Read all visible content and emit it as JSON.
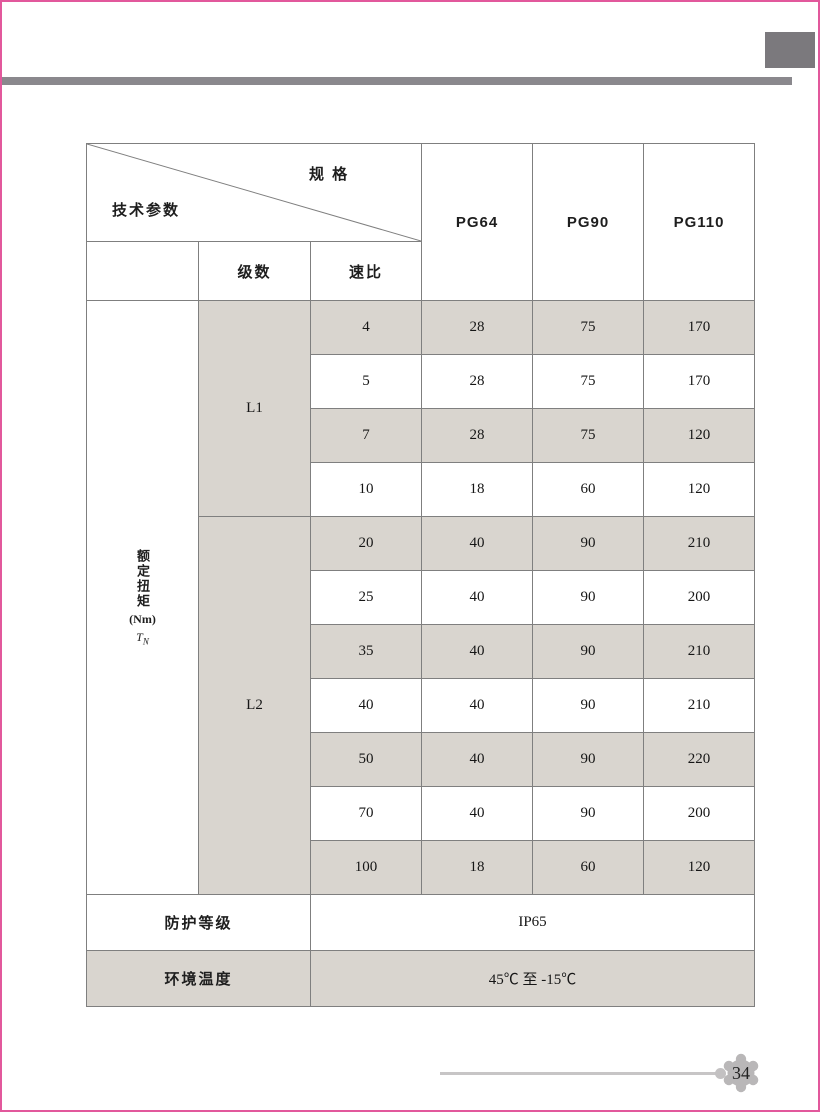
{
  "page": {
    "number": "34",
    "accent_color": "#e2589c",
    "bar_color": "#8a888d",
    "square_color": "#7b797d",
    "shade_color": "#d9d5cf"
  },
  "table": {
    "corner": {
      "top_label": "规 格",
      "bottom_label": "技术参数"
    },
    "model_columns": [
      "PG64",
      "PG90",
      "PG110"
    ],
    "sub_headers": {
      "stage": "级数",
      "ratio": "速比"
    },
    "torque": {
      "title": "额定扭矩",
      "unit": "(Nm)",
      "symbol": "T",
      "subscript": "N"
    },
    "groups": [
      {
        "stage": "L1",
        "rows": [
          {
            "ratio": "4",
            "pg64": "28",
            "pg90": "75",
            "pg110": "170"
          },
          {
            "ratio": "5",
            "pg64": "28",
            "pg90": "75",
            "pg110": "170"
          },
          {
            "ratio": "7",
            "pg64": "28",
            "pg90": "75",
            "pg110": "120"
          },
          {
            "ratio": "10",
            "pg64": "18",
            "pg90": "60",
            "pg110": "120"
          }
        ]
      },
      {
        "stage": "L2",
        "rows": [
          {
            "ratio": "20",
            "pg64": "40",
            "pg90": "90",
            "pg110": "210"
          },
          {
            "ratio": "25",
            "pg64": "40",
            "pg90": "90",
            "pg110": "200"
          },
          {
            "ratio": "35",
            "pg64": "40",
            "pg90": "90",
            "pg110": "210"
          },
          {
            "ratio": "40",
            "pg64": "40",
            "pg90": "90",
            "pg110": "210"
          },
          {
            "ratio": "50",
            "pg64": "40",
            "pg90": "90",
            "pg110": "220"
          },
          {
            "ratio": "70",
            "pg64": "40",
            "pg90": "90",
            "pg110": "200"
          },
          {
            "ratio": "100",
            "pg64": "18",
            "pg90": "60",
            "pg110": "120"
          }
        ]
      }
    ],
    "footer_rows": [
      {
        "label": "防护等级",
        "value": "IP65"
      },
      {
        "label": "环境温度",
        "value": "45℃ 至 -15℃"
      }
    ]
  }
}
